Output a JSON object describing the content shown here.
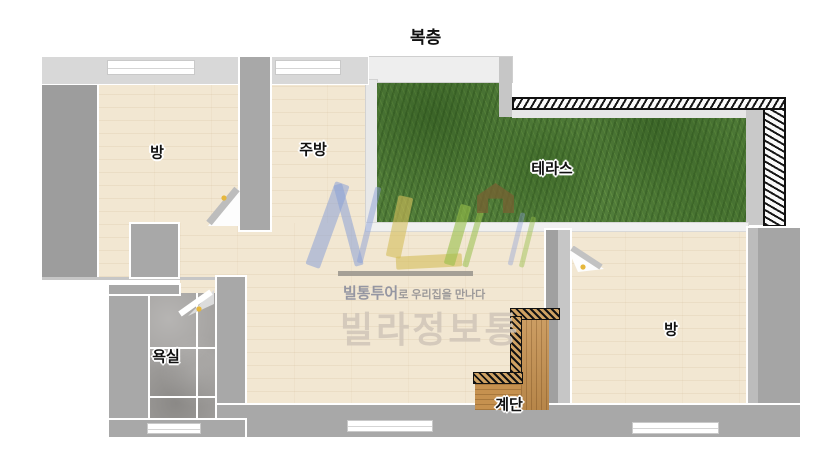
{
  "title": "복층",
  "labels": {
    "room_left": "방",
    "kitchen": "주방",
    "terrace": "테라스",
    "bathroom": "욕실",
    "stairs": "계단",
    "room_right": "방"
  },
  "watermark": {
    "slogan_brand": "빌통투어",
    "slogan_rest": "로 우리집을 만나다",
    "brand_large": "빌라정보통"
  },
  "colors": {
    "floor": "#f2e7d2",
    "wall": "#a8a8a8",
    "wall_light": "#d8d8d8",
    "grass": "#517c3a",
    "tile": "#a4a2a0",
    "wood": "#c6914f",
    "door_handle": "#e6b73c",
    "logo_blue": "#8ba0d6",
    "logo_yellow": "#d4be5a",
    "logo_green": "#97bf4a"
  }
}
